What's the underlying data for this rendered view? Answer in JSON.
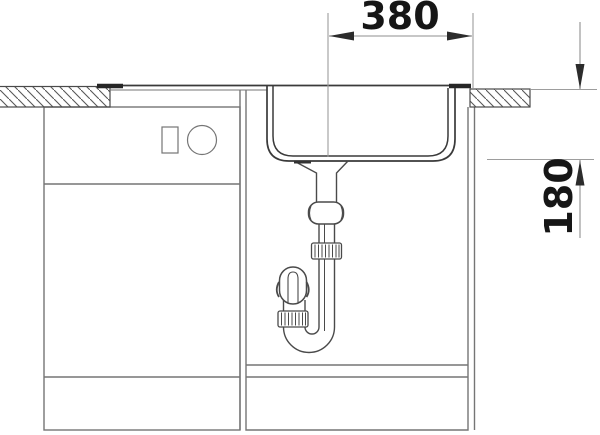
{
  "diagram": {
    "kind": "technical-drawing",
    "subject": "Kitchen sink installation cross-section with base cabinets and drain trap",
    "dimension_width": {
      "label": "380"
    },
    "dimension_depth": {
      "label": "180"
    },
    "colors": {
      "background": "#ffffff",
      "sink_outline": "#3a3a3a",
      "cabinet_outline": "#757575",
      "drain_outline": "#4a4a4a",
      "extension_line": "#9d9d9d",
      "dimension_line": "#8f8f8f",
      "arrow": "#2c2c2c",
      "label_text": "#161616",
      "hatch_stroke": "#585858"
    },
    "parts": [
      "wall-hatch-left",
      "countertop-hatch-right",
      "sink-rim",
      "sink-basin",
      "drain-funnel",
      "slip-nut",
      "pipe-coupling",
      "s-trap",
      "base-cabinet-left",
      "base-cabinet-sink",
      "plinth",
      "square-indicator",
      "round-knob"
    ]
  }
}
